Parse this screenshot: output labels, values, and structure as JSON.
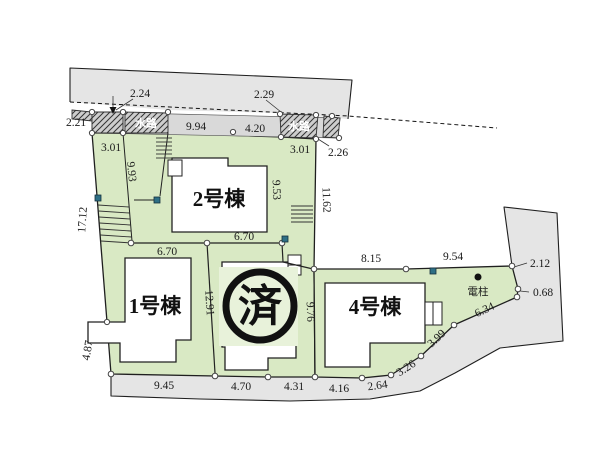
{
  "plan": {
    "buildings": {
      "unit1": "1号棟",
      "unit2": "2号棟",
      "unit4": "4号棟"
    },
    "sold_mark": "済",
    "waterway": "水路",
    "pole": "電柱",
    "dims": {
      "d224": "2.24",
      "d229": "2.29",
      "d221": "2.21",
      "d994": "9.94",
      "d420": "4.20",
      "d301L": "3.01",
      "d301R": "3.01",
      "d226": "2.26",
      "d993": "9.93",
      "d1712": "17.12",
      "d487": "4.87",
      "d670a": "6.70",
      "d670b": "6.70",
      "d953": "9.53",
      "d1162": "11.62",
      "d1291": "12.91",
      "d976": "9.76",
      "d815": "8.15",
      "d954": "9.54",
      "d212": "2.12",
      "d068": "0.68",
      "d945": "9.45",
      "d470": "4.70",
      "d431": "4.31",
      "d416": "4.16",
      "d264": "2.64",
      "d326": "3.26",
      "d399": "3.99",
      "d634": "6.34"
    }
  },
  "colors": {
    "parcel_green": "#d9e9c4",
    "sold_tint": "#e8f2da",
    "road_gray": "#e5e5e5",
    "strip_gray": "#d9d9d9",
    "hatch_gray": "#cdcdcd",
    "marker_blue": "#2e6f85",
    "line": "#1f1f1f"
  }
}
